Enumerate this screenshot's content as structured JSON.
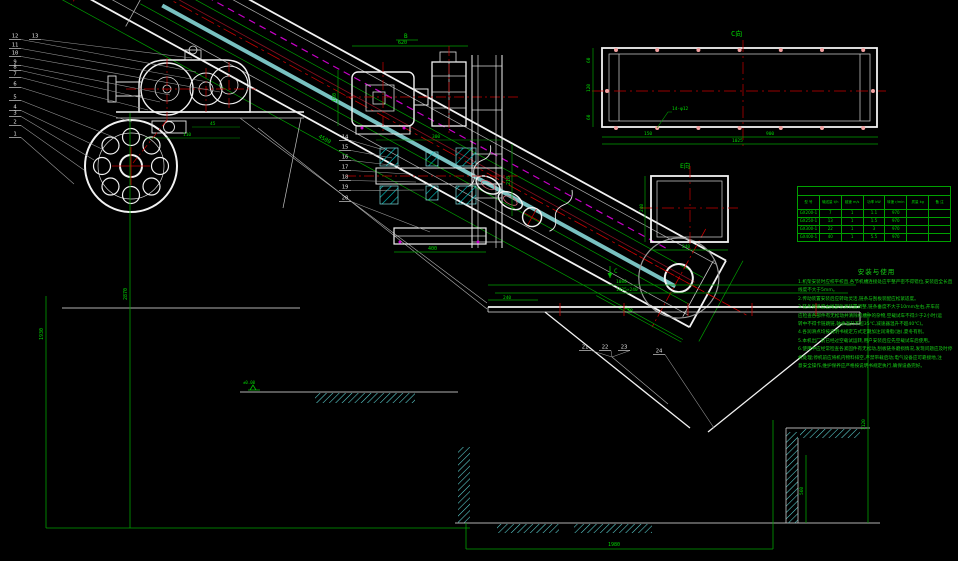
{
  "colors": {
    "background": "#000000",
    "line_white": "#f2f2f2",
    "line_gray": "#b0b0b0",
    "dim_green": "#00c000",
    "text_green": "#00d800",
    "center_red": "#c80000",
    "chain_magenta": "#c800c8",
    "hatch_cyan": "#00c8c8",
    "belt_cyan": "#8fe3e3",
    "bolt_pink": "#f2a0a0"
  },
  "labels": {
    "view_c": "C向",
    "view_e": "E向",
    "section_b": "B",
    "arrow_c": "C"
  },
  "dims": {
    "incline_length": "4500",
    "bottom_overall": "1980",
    "left_height": "1930",
    "head_height": "2870",
    "motor_top": "620",
    "motor_left": "160",
    "motor_bottom": "400",
    "motor_right": "210",
    "motor_mid": "300",
    "coupling_a": "45",
    "coupling_b": "110",
    "rect_left_a": "60",
    "rect_left_b": "120",
    "rect_left_c": "60",
    "rect_bottom_a": "150",
    "rect_bottom_b": "900",
    "rect_bottom_overall": "1025",
    "rect_holes": "14-φ12",
    "square_left": "240",
    "square_bottom": "240",
    "hopper_overall": "1080",
    "hopper_flange": "1025×240",
    "hopper_left": "240",
    "tail_width": "640",
    "right_dim_a": "560",
    "right_dim_b": "1120",
    "elevation": "±0.00"
  },
  "balloons": {
    "groups": [
      {
        "name": "left-parts",
        "items": [
          {
            "n": "12",
            "x": 10,
            "y": 38,
            "tx": 196,
            "ty": 72
          },
          {
            "n": "11",
            "x": 10,
            "y": 47,
            "tx": 208,
            "ty": 82
          },
          {
            "n": "10",
            "x": 10,
            "y": 55,
            "tx": 220,
            "ty": 92
          },
          {
            "n": "9",
            "x": 10,
            "y": 64,
            "tx": 170,
            "ty": 95
          },
          {
            "n": "8",
            "x": 10,
            "y": 69,
            "tx": 160,
            "ty": 102
          },
          {
            "n": "7",
            "x": 10,
            "y": 76,
            "tx": 148,
            "ty": 110
          },
          {
            "n": "6",
            "x": 10,
            "y": 86,
            "tx": 132,
            "ty": 122
          },
          {
            "n": "5",
            "x": 10,
            "y": 99,
            "tx": 116,
            "ty": 138
          },
          {
            "n": "4",
            "x": 10,
            "y": 109,
            "tx": 104,
            "ty": 150
          },
          {
            "n": "3",
            "x": 10,
            "y": 115,
            "tx": 94,
            "ty": 160
          },
          {
            "n": "2",
            "x": 10,
            "y": 124,
            "tx": 84,
            "ty": 170
          },
          {
            "n": "1",
            "x": 10,
            "y": 136,
            "tx": 74,
            "ty": 184
          }
        ]
      },
      {
        "name": "top-part",
        "items": [
          {
            "n": "13",
            "x": 30,
            "y": 38,
            "tx": 192,
            "ty": 58
          }
        ]
      },
      {
        "name": "drive-section-parts",
        "items": [
          {
            "n": "14",
            "x": 340,
            "y": 139,
            "tx": 384,
            "ty": 150
          },
          {
            "n": "15",
            "x": 340,
            "y": 149,
            "tx": 392,
            "ty": 158
          },
          {
            "n": "16",
            "x": 340,
            "y": 159,
            "tx": 400,
            "ty": 166
          },
          {
            "n": "17",
            "x": 340,
            "y": 169,
            "tx": 408,
            "ty": 174
          },
          {
            "n": "18",
            "x": 340,
            "y": 179,
            "tx": 416,
            "ty": 182
          },
          {
            "n": "19",
            "x": 340,
            "y": 189,
            "tx": 424,
            "ty": 190
          },
          {
            "n": "20",
            "x": 340,
            "y": 200,
            "tx": 430,
            "ty": 232
          }
        ]
      },
      {
        "name": "hopper-parts",
        "items": [
          {
            "n": "21",
            "x": 580,
            "y": 349,
            "tx": 612,
            "ty": 357
          },
          {
            "n": "22",
            "x": 600,
            "y": 349,
            "tx": 612,
            "ty": 357
          },
          {
            "n": "23",
            "x": 619,
            "y": 349,
            "tx": 612,
            "ty": 357
          },
          {
            "n": "24",
            "x": 654,
            "y": 353,
            "tx": 714,
            "ty": 428
          }
        ]
      }
    ]
  },
  "table": {
    "title": "性 能 参 数",
    "headers": [
      "型 号",
      "输送量 t/h",
      "链速 m/s",
      "功率 kW",
      "转速 r/min",
      "质量 kg",
      "备 注"
    ],
    "rows": [
      [
        "GX200-1",
        "7",
        "1",
        "1.1",
        "970",
        "",
        ""
      ],
      [
        "GX250-1",
        "13",
        "1",
        "1.5",
        "970",
        "",
        ""
      ],
      [
        "GX300-1",
        "22",
        "1",
        "3",
        "970",
        "",
        ""
      ],
      [
        "GX400-1",
        "40",
        "1",
        "5.5",
        "970",
        "",
        ""
      ]
    ]
  },
  "notes": {
    "title": "安装与使用",
    "lines": [
      "1.机架安装时应校平校直,各节机槽连接处应平整严密不得错位,安装后全长直",
      "  线度不大于5mm。",
      "2.传动装置安装后应转动灵活,链条与刮板装配应松紧适度。",
      "3.链条张紧度由尾部张紧装置调整,链条垂度不大于10mm左右,开车前",
      "  应检查各部件有无松动并清除机槽中的杂物,空载试车不得少于2小时(运",
      "  转中不得卡链跳链,轴承温升不超35℃,减速器温升不超40℃)。",
      "4.各润滑点均按说明书规定方式定期加注润滑脂(油),夏冬有别。",
      "5.本机出厂前已经过空载试运转,用户安装后应先空载试车后使用。",
      "6.使用中应经常检查各紧固件有无松动,刮板链条磨损情况,发现问题应及时停",
      "  机处理;停机前应将机内物料排空,严禁带载启动;电气设备应可靠接地,注",
      "  意安全操作,维护保养应严格按说明书规定执行,确保设备完好。"
    ]
  }
}
